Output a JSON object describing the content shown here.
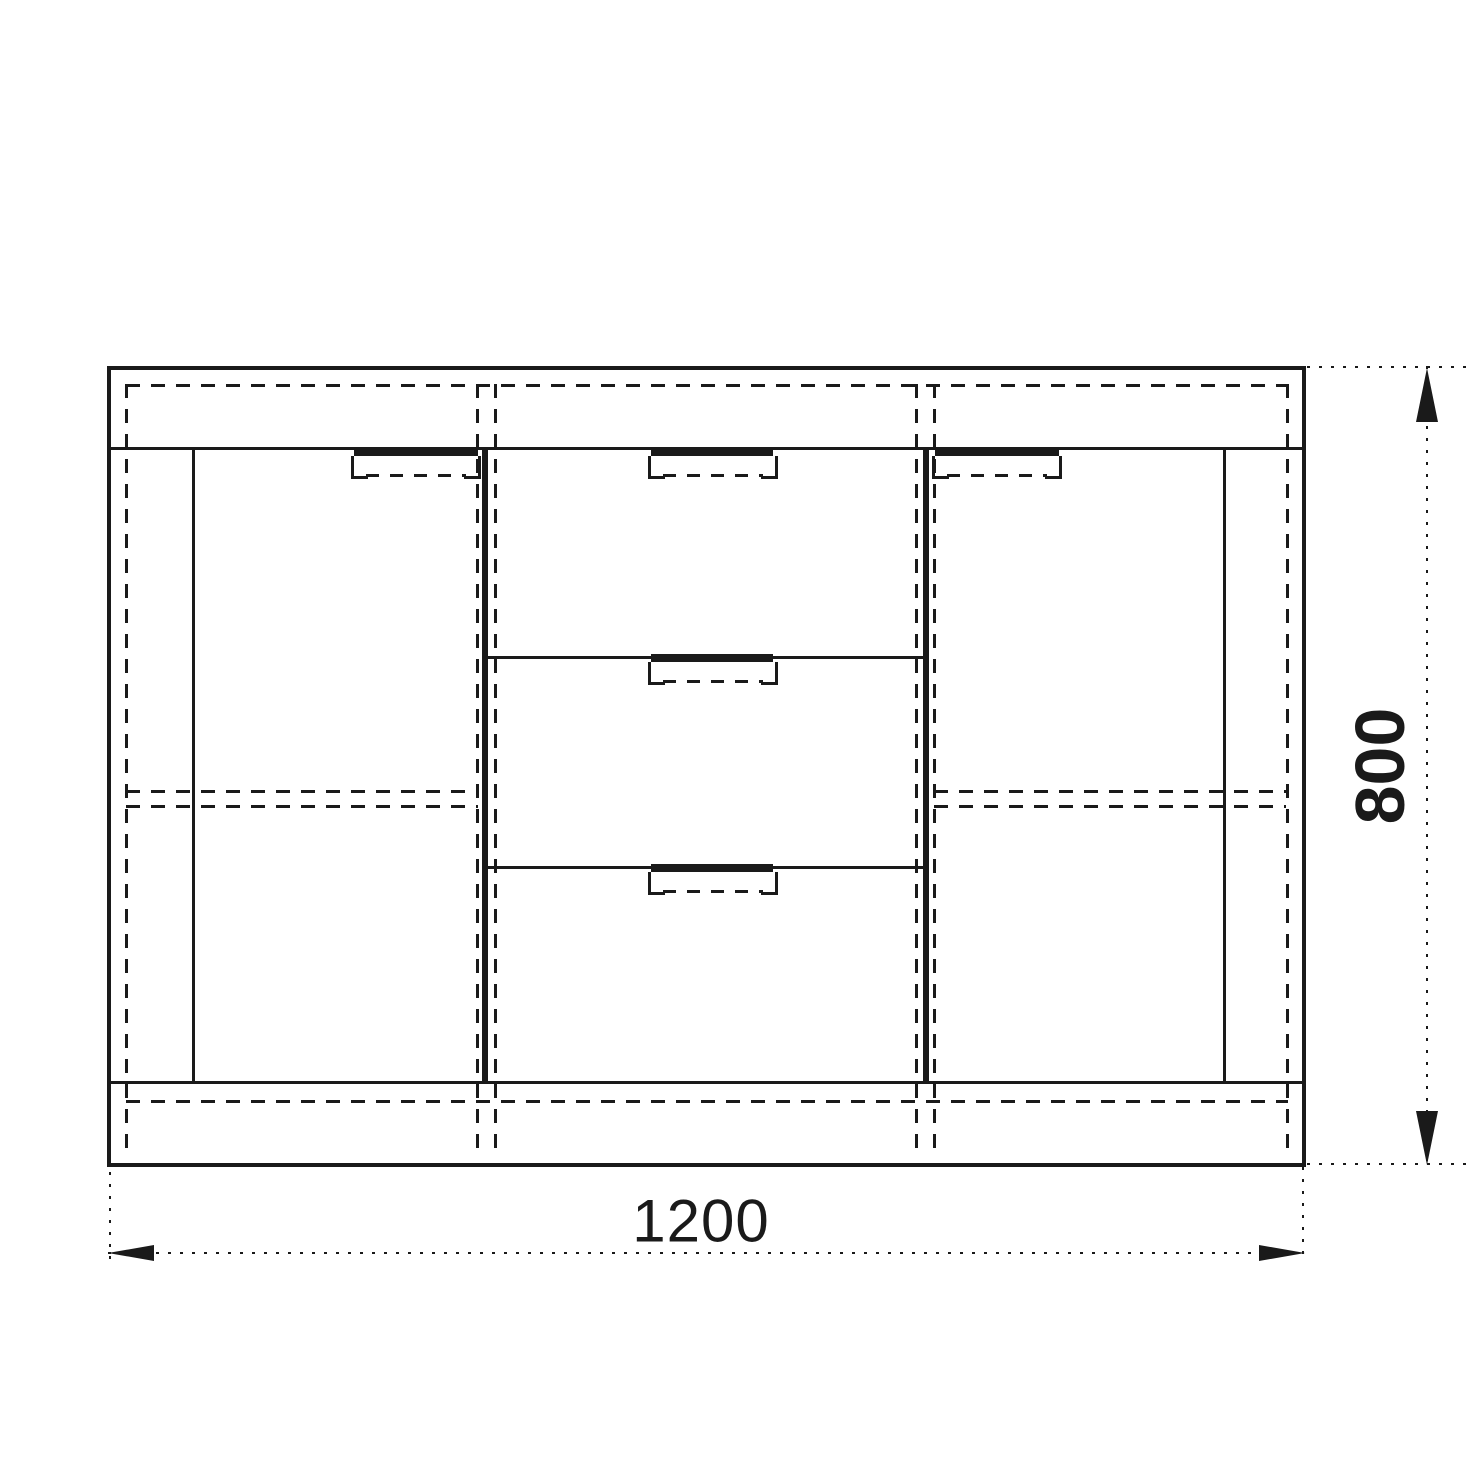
{
  "drawing": {
    "dimensions": {
      "width_label": "1200",
      "height_label": "800"
    },
    "cabinet": {
      "door_count": 2,
      "drawer_count": 3
    },
    "colors": {
      "line": "#1a1a1a",
      "background": "#ffffff"
    }
  }
}
